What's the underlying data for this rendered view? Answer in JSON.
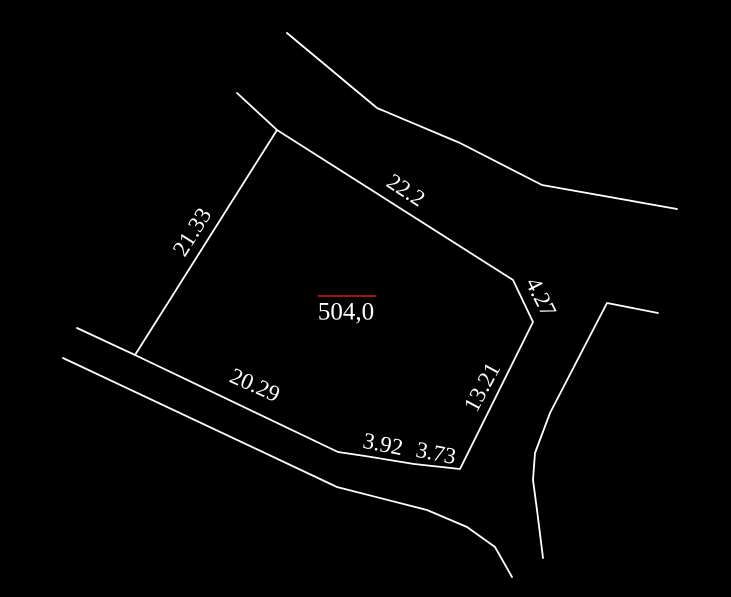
{
  "drawing": {
    "title": "cadastral parcel sketch",
    "width": 731,
    "height": 597,
    "background_color": "#000000",
    "line_color": "#ffffff",
    "line_width": 1.8,
    "dimension_font_size": 23,
    "parcel_area_label": {
      "text": "504,0",
      "color": "#cf1d1d",
      "x": 346,
      "y": 312,
      "font_size": 25,
      "overline": {
        "x1": 318,
        "y1": 296,
        "x2": 376,
        "y2": 296
      }
    },
    "dimension_labels": [
      {
        "text": "21.33",
        "x": 192,
        "y": 232,
        "rotation": -58
      },
      {
        "text": "22.2",
        "x": 406,
        "y": 190,
        "rotation": 33
      },
      {
        "text": "4.27",
        "x": 541,
        "y": 297,
        "rotation": 63
      },
      {
        "text": "13.21",
        "x": 482,
        "y": 387,
        "rotation": -62
      },
      {
        "text": "20.29",
        "x": 255,
        "y": 385,
        "rotation": 24
      },
      {
        "text": "3.92",
        "x": 383,
        "y": 444,
        "rotation": 11
      },
      {
        "text": "3.73",
        "x": 436,
        "y": 453,
        "rotation": 11
      }
    ],
    "polylines": [
      {
        "name": "upper-road-far-edge",
        "points": "287,33 377,108 460,143 542,185 677,209",
        "closed": false
      },
      {
        "name": "upper-road-near-edge",
        "points": "237,93 277,130",
        "closed": false
      },
      {
        "name": "parcel-boundary",
        "points": "277,130 513,280 533,322 460,469 414,464 365,456 338,452 135,355",
        "closed": true
      },
      {
        "name": "lower-road-near-edge",
        "points": "77,328 135,355",
        "closed": false
      },
      {
        "name": "lower-road-far-edge",
        "points": "63,358 337,487 427,510 467,527 495,547 512,577",
        "closed": false
      },
      {
        "name": "right-road-far-edge",
        "points": "658,313 607,303 550,413 535,453 533,480 537,510 543,558",
        "closed": false
      }
    ]
  }
}
